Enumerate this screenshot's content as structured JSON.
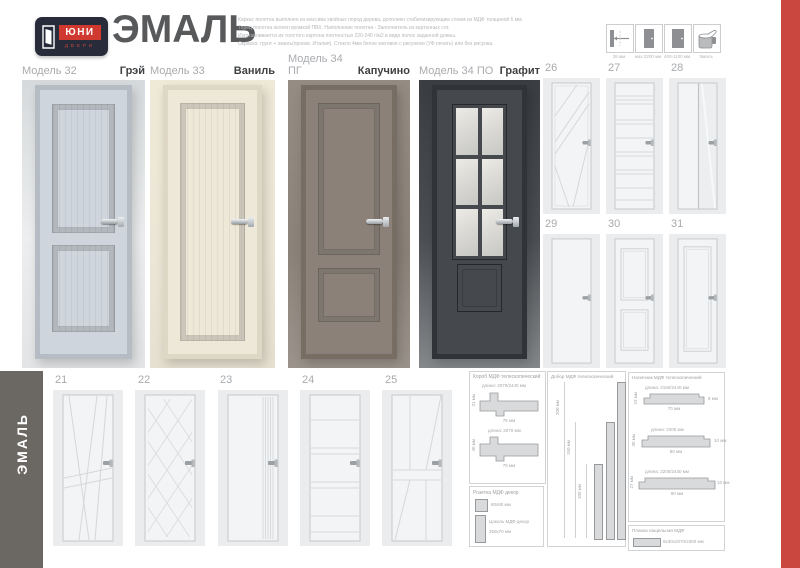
{
  "colors": {
    "accent_red": "#c9473f",
    "sidebar_gray": "#6b6762",
    "logo_navy": "#272b3a",
    "logo_red": "#d0392f"
  },
  "header": {
    "logo": {
      "brand": "ЮНИ",
      "sub": "ДВЕРИ"
    },
    "title": "ЭМАЛЬ",
    "description_lines": [
      "Каркас полотна выполнен из массива хвойных пород дерева, дополнен стабилизирующим слоем из МДФ толщиной 6 мм.",
      "Торец полотна оклеен кромкой ПВХ. Наполнение полотна - Заполнитель из картонных сот.",
      "Изготавливается из толстого картона плотностью 220-240 г/м2 в виде полос заданной длины.",
      "Окраска: грунт + эмаль(произв. Италия). Стекло 4мм белое матовое с рисунком (УФ печать) или без рисунка."
    ],
    "spec_icons": [
      {
        "icon": "door-thickness-icon",
        "caption": "38 мм"
      },
      {
        "icon": "door-height-icon",
        "caption": "мах 2200 мм"
      },
      {
        "icon": "door-width-icon",
        "caption": "400-1100 мм"
      },
      {
        "icon": "enamel-paint-icon",
        "caption": "Эмаль"
      }
    ]
  },
  "main_doors": [
    {
      "model": "Модель 32",
      "color_name": "Грэй",
      "door_color": "#cfd5dc"
    },
    {
      "model": "Модель 33",
      "color_name": "Ваниль",
      "door_color": "#eee8d8"
    },
    {
      "model": "Модель 34 ПГ",
      "color_name": "Капучино",
      "door_color": "#8b8179"
    },
    {
      "model": "Модель 34 ПО",
      "color_name": "Графит",
      "door_color": "#45484d"
    }
  ],
  "right_thumbnails": [
    {
      "number": "26"
    },
    {
      "number": "27"
    },
    {
      "number": "28"
    },
    {
      "number": "29"
    },
    {
      "number": "30"
    },
    {
      "number": "31"
    }
  ],
  "bottom_thumbnails": [
    {
      "number": "21"
    },
    {
      "number": "22"
    },
    {
      "number": "23"
    },
    {
      "number": "24"
    },
    {
      "number": "25"
    }
  ],
  "sidebar": {
    "label": "ЭМАЛЬ"
  },
  "tech": {
    "korob": {
      "title": "Короб МДФ телескопический",
      "profiles": [
        {
          "length": "длина: 2070/2440 мм",
          "depth": "31 мм",
          "width": "75 мм"
        },
        {
          "length": "длина: 2070 мм",
          "depth": "40 мм",
          "width": "75 мм"
        }
      ]
    },
    "decor": {
      "rozetka_title": "Розетка МДФ декор",
      "rozetka_size": "80х80 мм",
      "tsokol_title": "Цоколь МДФ декор",
      "tsokol_size": "250х70 мм"
    },
    "dobor": {
      "title": "Добор МДФ телескопический",
      "sizes": [
        "200 мм",
        "150 мм",
        "100 мм"
      ]
    },
    "nalichnik": {
      "title": "Наличник МДФ телескопический",
      "profiles": [
        {
          "length": "длина: 2150/2440 мм",
          "depth": "23 мм",
          "width": "70 мм",
          "side": "8 мм"
        },
        {
          "length": "длина: 2200 мм",
          "depth": "30 мм",
          "width": "80 мм",
          "side": "10 мм"
        },
        {
          "length": "длина: 2200/2440 мм",
          "depth": "27 мм",
          "width": "90 мм",
          "side": "10 мм"
        }
      ]
    },
    "planka": {
      "title": "Планка нащельная МДФ",
      "size": "8х30х2070/2300 мм"
    }
  }
}
